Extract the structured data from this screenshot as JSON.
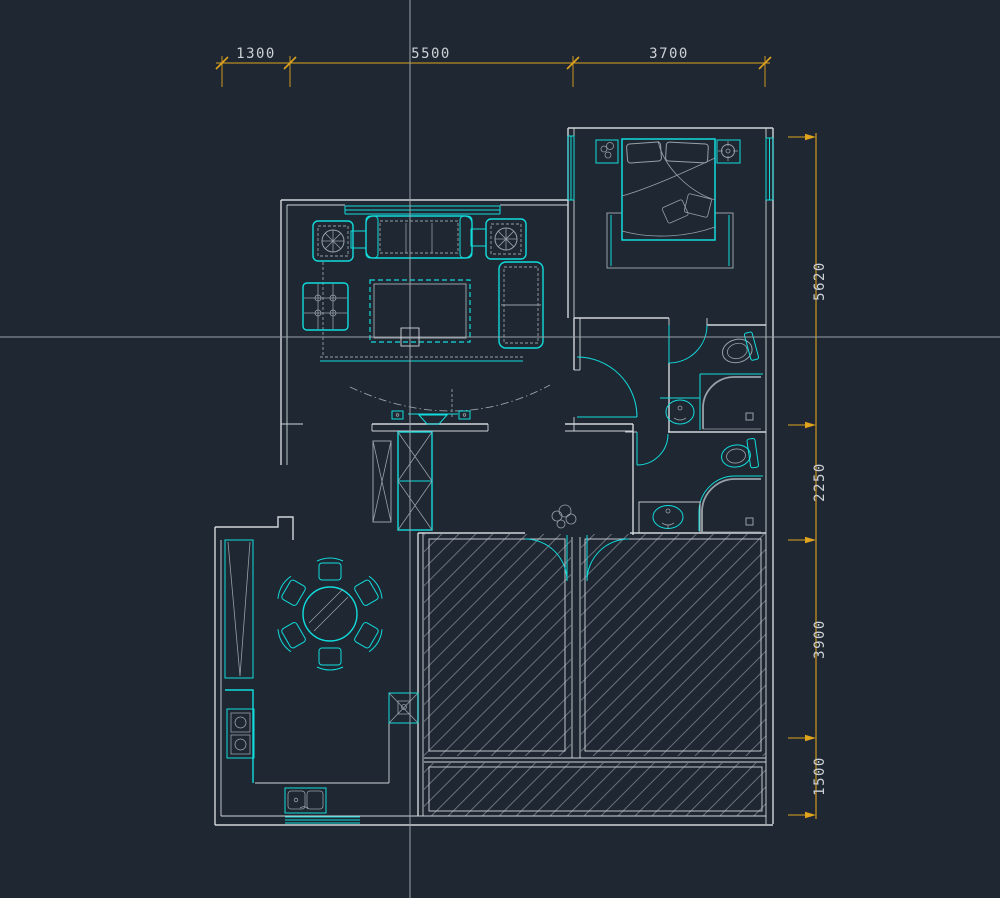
{
  "application": {
    "canvas_type": "cad-floor-plan-view"
  },
  "colors": {
    "background": "#1e2732",
    "wall": "#d2d6da",
    "detail_gray": "#98a0a8",
    "hatch_gray": "#6a727c",
    "furniture_cyan": "#12dcdc",
    "dimension_yellow": "#e0a31e",
    "dimension_text": "#ccd1d6",
    "crosshair": "#9aa2aa"
  },
  "cursor": {
    "x": 410,
    "y": 337
  },
  "dimensions": {
    "top": [
      {
        "label": "1300"
      },
      {
        "label": "5500"
      },
      {
        "label": "3700"
      }
    ],
    "right": [
      {
        "label": "5620"
      },
      {
        "label": "2250"
      },
      {
        "label": "3900"
      },
      {
        "label": "1500"
      }
    ]
  },
  "plan": {
    "rooms": [
      "living-room",
      "master-bedroom",
      "ensuite-bathroom",
      "second-bathroom",
      "hallway",
      "dining-room",
      "kitchen",
      "unfurnished-room-left",
      "unfurnished-room-right",
      "balcony-strip"
    ],
    "furniture": [
      "three-seat-sofa",
      "armchair-left",
      "armchair-right",
      "side-tables",
      "coffee-table",
      "lattice-plant-box",
      "chaise",
      "entry-cabinet",
      "ceiling-lamp",
      "plant",
      "round-dining-table",
      "dining-chairs",
      "tall-cabinet",
      "kitchen-counter",
      "stove",
      "double-sink",
      "service-column",
      "double-bed",
      "pillows",
      "nightstand-plant",
      "nightstand-lamp",
      "bedside-rug",
      "toilet",
      "corner-shower",
      "washbasin"
    ]
  }
}
